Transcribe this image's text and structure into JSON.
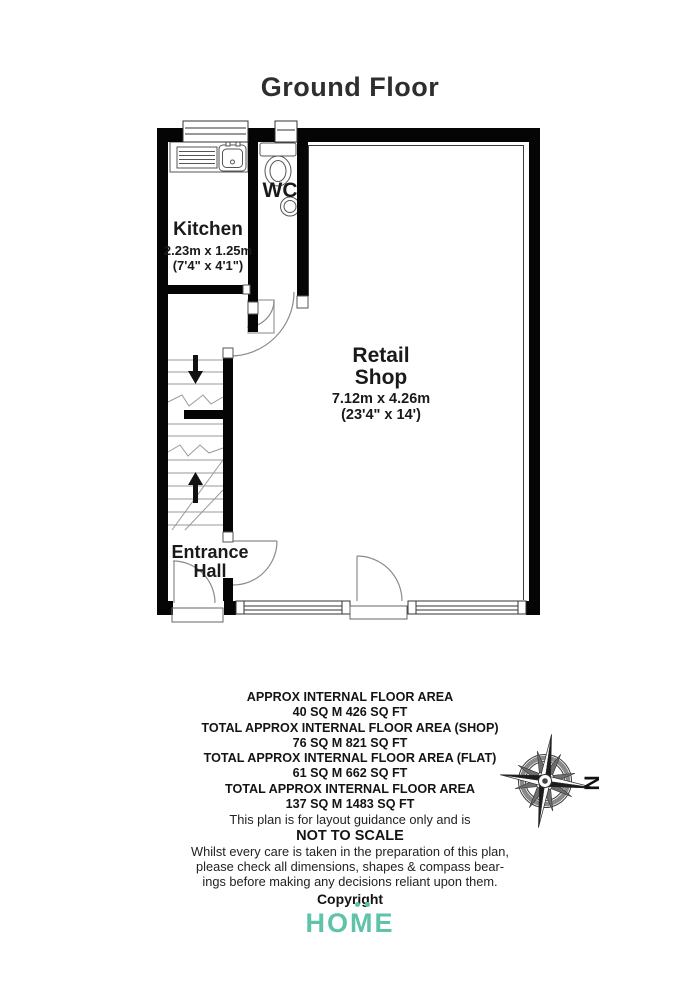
{
  "title": "Ground Floor",
  "compass": {
    "north_label": "N"
  },
  "rooms": {
    "kitchen": {
      "name": "Kitchen",
      "dims_metric": "2.23m x 1.25m",
      "dims_imperial": "(7'4\" x 4'1\")"
    },
    "wc": {
      "name": "WC"
    },
    "retail_shop": {
      "name_line1": "Retail",
      "name_line2": "Shop",
      "dims_metric": "7.12m x 4.26m",
      "dims_imperial": "(23'4\" x 14')"
    },
    "entrance_hall": {
      "name_line1": "Entrance",
      "name_line2": "Hall"
    }
  },
  "footer": {
    "area_summary": [
      {
        "label": "APPROX INTERNAL FLOOR AREA",
        "value": "40 SQ M 426 SQ FT"
      },
      {
        "label": "TOTAL APPROX INTERNAL FLOOR AREA (SHOP)",
        "value": "76 SQ M 821 SQ FT"
      },
      {
        "label": "TOTAL APPROX INTERNAL FLOOR AREA (FLAT)",
        "value": "61 SQ M 662 SQ FT"
      },
      {
        "label": "TOTAL APPROX INTERNAL FLOOR AREA",
        "value": "137 SQ M 1483 SQ FT"
      }
    ],
    "guidance": "This plan is for layout guidance only and is",
    "not_to_scale": "NOT TO SCALE",
    "disclaimer_lines": [
      "Whilst every care is taken in the preparation of this plan,",
      "please check all dimensions, shapes & compass bear-",
      "ings before making any decisions reliant upon them."
    ],
    "copyright": "Copyright",
    "brand": "HOME"
  },
  "colors": {
    "brand_teal": "#5ec3a8",
    "wall_black": "#050505"
  }
}
